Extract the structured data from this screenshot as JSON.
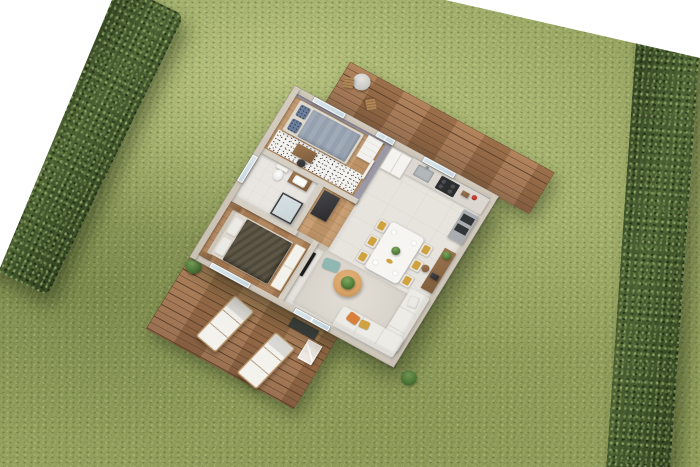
{
  "scene": {
    "type": "3d-isometric-floor-plan-render",
    "environment": {
      "background": "white",
      "lawn": "grass",
      "hedge_left": "boundary hedge",
      "hedge_right": "boundary hedge"
    },
    "house": {
      "rooms": [
        {
          "id": "bedroom-small",
          "floor": "wood",
          "items": [
            "single-bed",
            "patterned-pillows",
            "dresser",
            "desk",
            "chair",
            "radiator",
            "speckled-rug"
          ]
        },
        {
          "id": "bathroom",
          "floor": "tile",
          "items": [
            "toilet",
            "vanity-sink",
            "glass-shower",
            "laundry-cabinet"
          ]
        },
        {
          "id": "hallway",
          "floor": "wood",
          "items": []
        },
        {
          "id": "master-bedroom",
          "floor": "wood",
          "items": [
            "double-bed",
            "nightstand",
            "nightstand",
            "bench"
          ]
        },
        {
          "id": "kitchen",
          "floor": "tile",
          "items": [
            "fridge",
            "counter",
            "sink",
            "cooktop",
            "oven-column",
            "red-kettle",
            "cutting-board"
          ]
        },
        {
          "id": "dining-area",
          "floor": "tile",
          "items": [
            "dining-table",
            "chairs",
            "plates",
            "centerpiece-plant",
            "sideboard",
            "stool",
            "laptop"
          ]
        },
        {
          "id": "living-room",
          "floor": "tile",
          "items": [
            "corner-sofa",
            "throw-cushions",
            "coffee-table",
            "plant",
            "rug",
            "tv",
            "floor-cushion"
          ]
        }
      ],
      "openings": [
        "bedroom-window-north",
        "terrace-door-north",
        "kitchen-window-north",
        "bathroom-window-west",
        "master-window-south",
        "living-glass-door-south"
      ]
    },
    "terraces": {
      "north": [
        "wood-deck",
        "bistro-table",
        "bistro-chairs"
      ],
      "south": [
        "wood-deck",
        "sun-loungers",
        "planter",
        "doormat",
        "outdoor-rack",
        "shrub"
      ]
    },
    "counts": {
      "bedrooms": 2,
      "dining_chairs": 6,
      "sun_loungers": 2,
      "bistro_chairs": 2
    }
  },
  "palette": {
    "background": "#ffffff",
    "grass_base": "#94a25e",
    "grass_light": "#bcc583",
    "grass_dark": "#6d7d43",
    "hedge_base": "#3a4e23",
    "hedge_light": "#6d8243",
    "deck_wood": "#ad7c52",
    "deck_wood_dark": "#936847",
    "deck_gap": "#5b3f28",
    "wall_exterior": "#c9c1b4",
    "wall_interior": "#d6cfc3",
    "wall_accent": "#9b98a7",
    "floor_wood": "#c5996b",
    "floor_wood_dark": "#b3855a",
    "floor_tile": "#e7e4de",
    "speckle_base": "#f4f2ee",
    "rug_living": "#d9d4cb",
    "sofa": "#ecebe6",
    "cushion_orange": "#d97f3a",
    "cushion_yellow": "#d0a23f",
    "cushion_teal": "#8fb8b2",
    "duvet_master": "#5e5746",
    "duvet_guest": "#96a1b0",
    "table_wood": "#d7a266",
    "glass": "#d9e6ec",
    "appliance_dark": "#2c2d2f",
    "plant_green": "#4e7a38"
  }
}
